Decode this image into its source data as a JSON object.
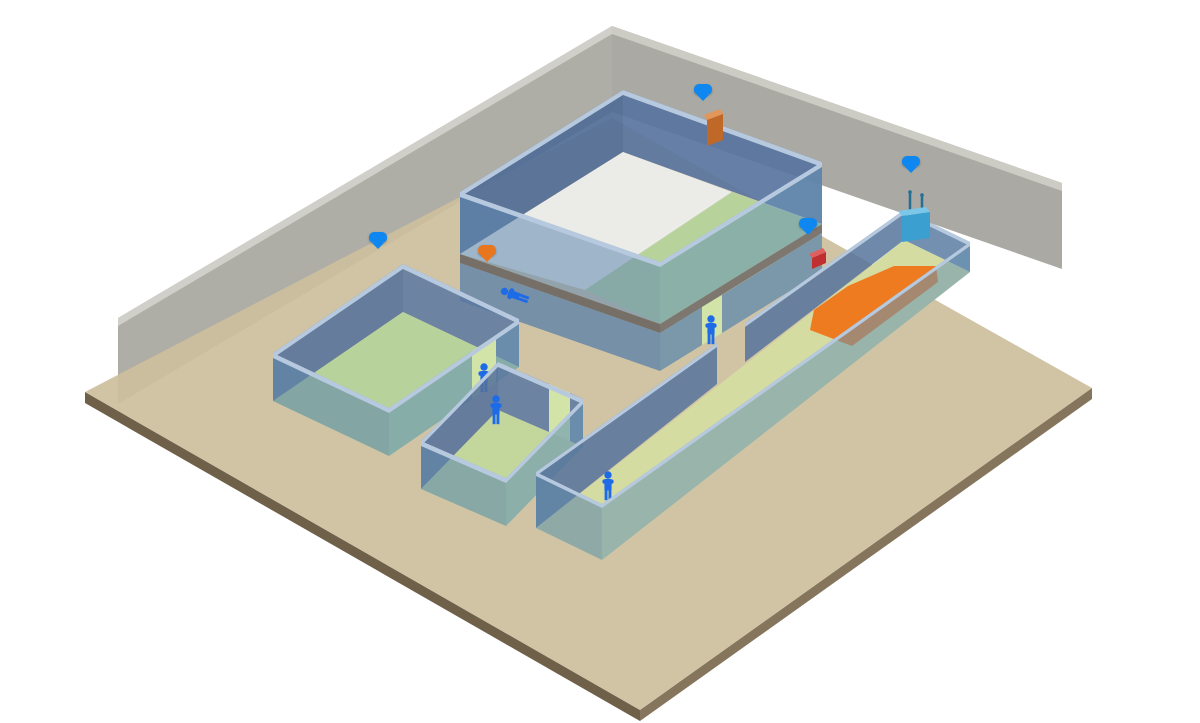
{
  "badges": {
    "exciter": {
      "label": "激励器",
      "color": "#0f87f0"
    },
    "base_station": {
      "label": "通讯基站",
      "color": "#0f87f0"
    },
    "smart_alarm": {
      "label": "智能报警",
      "color": "#0f87f0"
    },
    "anchor": {
      "label": "定位锚点",
      "color": "#0f87f0"
    },
    "sos": {
      "label": "一键求救",
      "color": "#e8761f"
    }
  },
  "zones": {
    "zone_3d": "三维定位",
    "zone_2d": "二维定位",
    "zone_presence": "存在定位",
    "zone_1d": "一维定位",
    "zone_fence": "电子围栏"
  },
  "colors": {
    "badge_blue": "#0f87f0",
    "badge_orange": "#e8761f",
    "fence_orange": "#ee7b20",
    "room_floor_green": "#b7d39b",
    "corridor_floor_green": "#d5dca1",
    "wall_far_blue": "#5d7fa8",
    "wall_near_teal": "#6fa0b4",
    "ground_tan": "#cec09e",
    "back_wall_gray": "#a5a49c",
    "person_blue": "#1e6be8",
    "anchor_dot_orange": "#e08a1e",
    "stair_cream": "#eee9d8"
  }
}
